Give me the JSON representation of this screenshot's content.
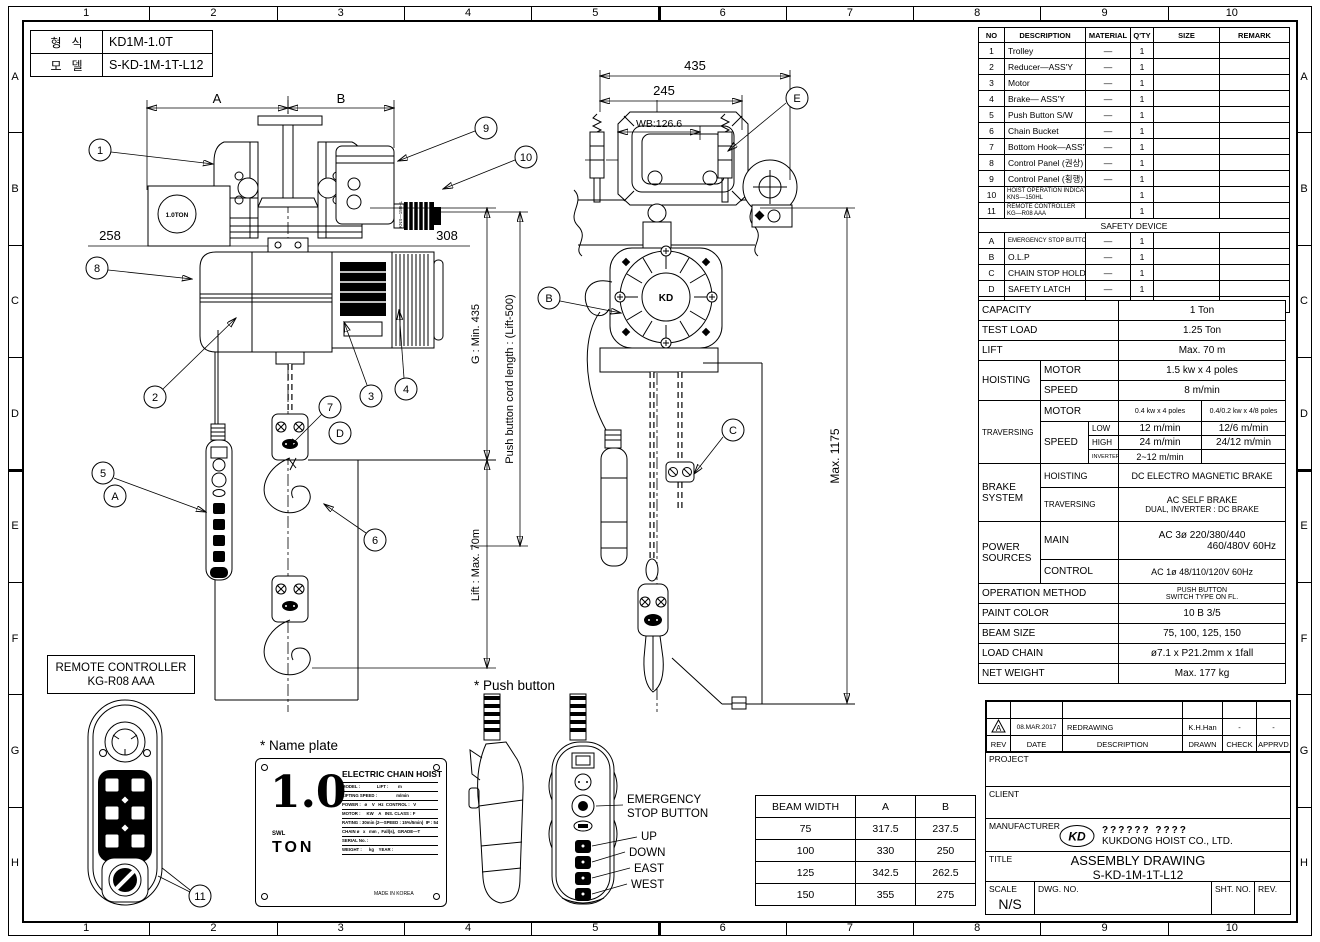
{
  "sheet": {
    "grid_top": [
      "1",
      "2",
      "3",
      "4",
      "5",
      "6",
      "7",
      "8",
      "9",
      "10"
    ],
    "grid_bottom": [
      "1",
      "2",
      "3",
      "4",
      "5",
      "6",
      "7",
      "8",
      "9",
      "10"
    ],
    "grid_left": [
      "A",
      "B",
      "C",
      "D",
      "E",
      "F",
      "G",
      "H"
    ],
    "grid_right": [
      "A",
      "B",
      "C",
      "D",
      "E",
      "F",
      "G",
      "H"
    ]
  },
  "type_table": {
    "row1_label": "형   식",
    "row1_value": "KD1M-1.0T",
    "row2_label": "모   델",
    "row2_value": "S-KD-1M-1T-L12"
  },
  "parts": {
    "headers": [
      "NO",
      "DESCRIPTION",
      "MATERIAL",
      "Q'TY",
      "SIZE",
      "REMARK"
    ],
    "rows": [
      [
        "1",
        "Trolley",
        "—",
        "1"
      ],
      [
        "2",
        "Reducer—ASS'Y",
        "—",
        "1"
      ],
      [
        "3",
        "Motor",
        "—",
        "1"
      ],
      [
        "4",
        "Brake— ASS'Y",
        "—",
        "1"
      ],
      [
        "5",
        "Push Button S/W",
        "—",
        "1"
      ],
      [
        "6",
        "Chain Bucket",
        "—",
        "1"
      ],
      [
        "7",
        "Bottom Hook—ASS'Y",
        "—",
        "1"
      ],
      [
        "8",
        "Control Panel (권상)",
        "—",
        "1"
      ],
      [
        "9",
        "Control Panel (횡행)",
        "—",
        "1"
      ]
    ],
    "row10": {
      "no": "10",
      "line1": "HOIST OPERATION INDICATOR LIGHT",
      "line2": "KNS—150HL",
      "qty": "1"
    },
    "row11": {
      "no": "11",
      "line1": "REMOTE CONTROLLER",
      "line2": "KG—R08 AAA",
      "qty": "1"
    },
    "safety_title": "SAFETY DEVICE",
    "safety_rows": [
      [
        "A",
        "EMERGENCY STOP BUTTON S/W",
        "—",
        "1"
      ],
      [
        "B",
        "O.L.P",
        "—",
        "1"
      ],
      [
        "C",
        "CHAIN STOP HOLDER",
        "—",
        "1"
      ],
      [
        "D",
        "SAFETY LATCH",
        "—",
        "1"
      ],
      [
        "E",
        "LIMIT S/W (횡행)",
        "—",
        "1"
      ]
    ]
  },
  "spec": {
    "capacity_label": "CAPACITY",
    "capacity_value": "1 Ton",
    "test_load_label": "TEST LOAD",
    "test_load_value": "1.25 Ton",
    "lift_label": "LIFT",
    "lift_value": "Max. 70 m",
    "hoisting_label": "HOISTING",
    "motor_label": "MOTOR",
    "speed_label": "SPEED",
    "hoist_motor_value": "1.5 kw x 4 poles",
    "hoist_speed_value": "8 m/min",
    "traversing_label": "TRAVERSING",
    "trav_motor_label": "MOTOR",
    "trav_speed_label": "SPEED",
    "trav_motor_a": "0.4 kw x 4 poles",
    "trav_motor_b": "0.4/0.2 kw x 4/8 poles",
    "low_label": "LOW",
    "low_a": "12 m/min",
    "low_b": "12/6 m/min",
    "high_label": "HIGH",
    "high_a": "24 m/min",
    "high_b": "24/12 m/min",
    "inverter_label": "INVERTER",
    "inverter_a": "2~12 m/min",
    "brake_label_1": "BRAKE",
    "brake_label_2": "SYSTEM",
    "brake_hoisting_label": "HOISTING",
    "brake_hoisting_value": "DC ELECTRO MAGNETIC BRAKE",
    "brake_traversing_label": "TRAVERSING",
    "brake_traversing_value_1": "AC SELF BRAKE",
    "brake_traversing_value_2": "DUAL, INVERTER : DC BRAKE",
    "power_label_1": "POWER",
    "power_label_2": "SOURCES",
    "main_label": "MAIN",
    "main_value_1": "AC 3ø  220/380/440",
    "main_value_2": "460/480V 60Hz",
    "control_label": "CONTROL",
    "control_value": "AC 1ø 48/110/120V 60Hz",
    "operation_label": "OPERATION METHOD",
    "operation_value_1": "PUSH BUTTON",
    "operation_value_2": "SWITCH TYPE ON FL.",
    "paint_label": "PAINT COLOR",
    "paint_value": "10 B 3/5",
    "beam_label": "BEAM SIZE",
    "beam_value": "75, 100, 125, 150",
    "chain_label": "LOAD CHAIN",
    "chain_value": "ø7.1 x P21.2mm x 1fall",
    "weight_label": "NET WEIGHT",
    "weight_value": "Max. 177 kg"
  },
  "beam_table": {
    "headers": [
      "BEAM WIDTH",
      "A",
      "B"
    ],
    "rows": [
      [
        "75",
        "317.5",
        "237.5"
      ],
      [
        "100",
        "330",
        "250"
      ],
      [
        "125",
        "342.5",
        "262.5"
      ],
      [
        "150",
        "355",
        "275"
      ]
    ]
  },
  "titleblock": {
    "rev_a": {
      "rev": "A",
      "date": "08.MAR.2017",
      "desc": "REDRAWING",
      "drawn": "K.H.Han",
      "check": "-",
      "apprvd": "-"
    },
    "headers": {
      "rev": "REV",
      "date": "DATE",
      "desc": "DESCRIPTION",
      "drawn": "DRAWN",
      "check": "CHECK",
      "apprvd": "APPRVD"
    },
    "project_label": "PROJECT",
    "client_label": "CLIENT",
    "manufacturer_label": "MANUFACTURER",
    "logo_text": "KD",
    "company_line1": "?????? ????",
    "company_line2": "KUKDONG HOIST CO., LTD.",
    "title_label": "TITLE",
    "title_line1": "ASSEMBLY DRAWING",
    "title_line2": "S-KD-1M-1T-L12",
    "scale_label": "SCALE",
    "scale_value": "N/S",
    "dwg_no_label": "DWG. NO.",
    "sht_no_label": "SHT. NO.",
    "rev_label": "REV."
  },
  "details": {
    "remote_label_line1": "REMOTE CONTROLLER",
    "remote_label_line2": "KG-R08 AAA",
    "name_plate_heading": "* Name plate",
    "push_button_heading": "* Push button",
    "plate": {
      "capacity": "1.0",
      "swl": "SWL",
      "ton": "TON",
      "title": "ELECTRIC CHAIN HOIST",
      "rows": [
        "MODEL :              LIFT :        m",
        "LIFTING SPEED :                m/min",
        "POWER :   ø    V   Hz  CONTROL :   V",
        "MOTOR :     KW    A   INS. CLASS : F",
        "RATING : 30min (2—SPEED : 15%/5min)  IP : 54",
        "CHAIN ø   x   mm ,  Fall(s),  GRADE—T",
        "SERIAL No. :",
        "WEIGHT :      kg    YEAR :"
      ],
      "made_in": "MADE IN KOREA"
    },
    "pb_labels": {
      "estop1": "EMERGENCY",
      "estop2": "STOP BUTTON",
      "up": "UP",
      "down": "DOWN",
      "east": "EAST",
      "west": "WEST"
    }
  },
  "drawing": {
    "dim_a": "A",
    "dim_b": "B",
    "dim_258": "258",
    "dim_308": "308",
    "dim_g": "G : Min. 435",
    "dim_lift": "Lift : Max. 70m",
    "dim_cord": "Push button cord length : (Lift-500)",
    "dim_435": "435",
    "dim_245": "245",
    "dim_wb": "WB:126.6",
    "dim_1175": "Max. 1175",
    "ton_badge": "1.0TON",
    "indicator_text": "KNS—150HL",
    "motor_logo": "KD",
    "callouts": {
      "c1": "1",
      "c2": "2",
      "c3": "3",
      "c4": "4",
      "c5": "5",
      "c6": "6",
      "c7": "7",
      "c8": "8",
      "c9": "9",
      "c10": "10",
      "c11": "11",
      "cA": "A",
      "cB": "B",
      "cC": "C",
      "cD": "D",
      "cE": "E"
    }
  }
}
